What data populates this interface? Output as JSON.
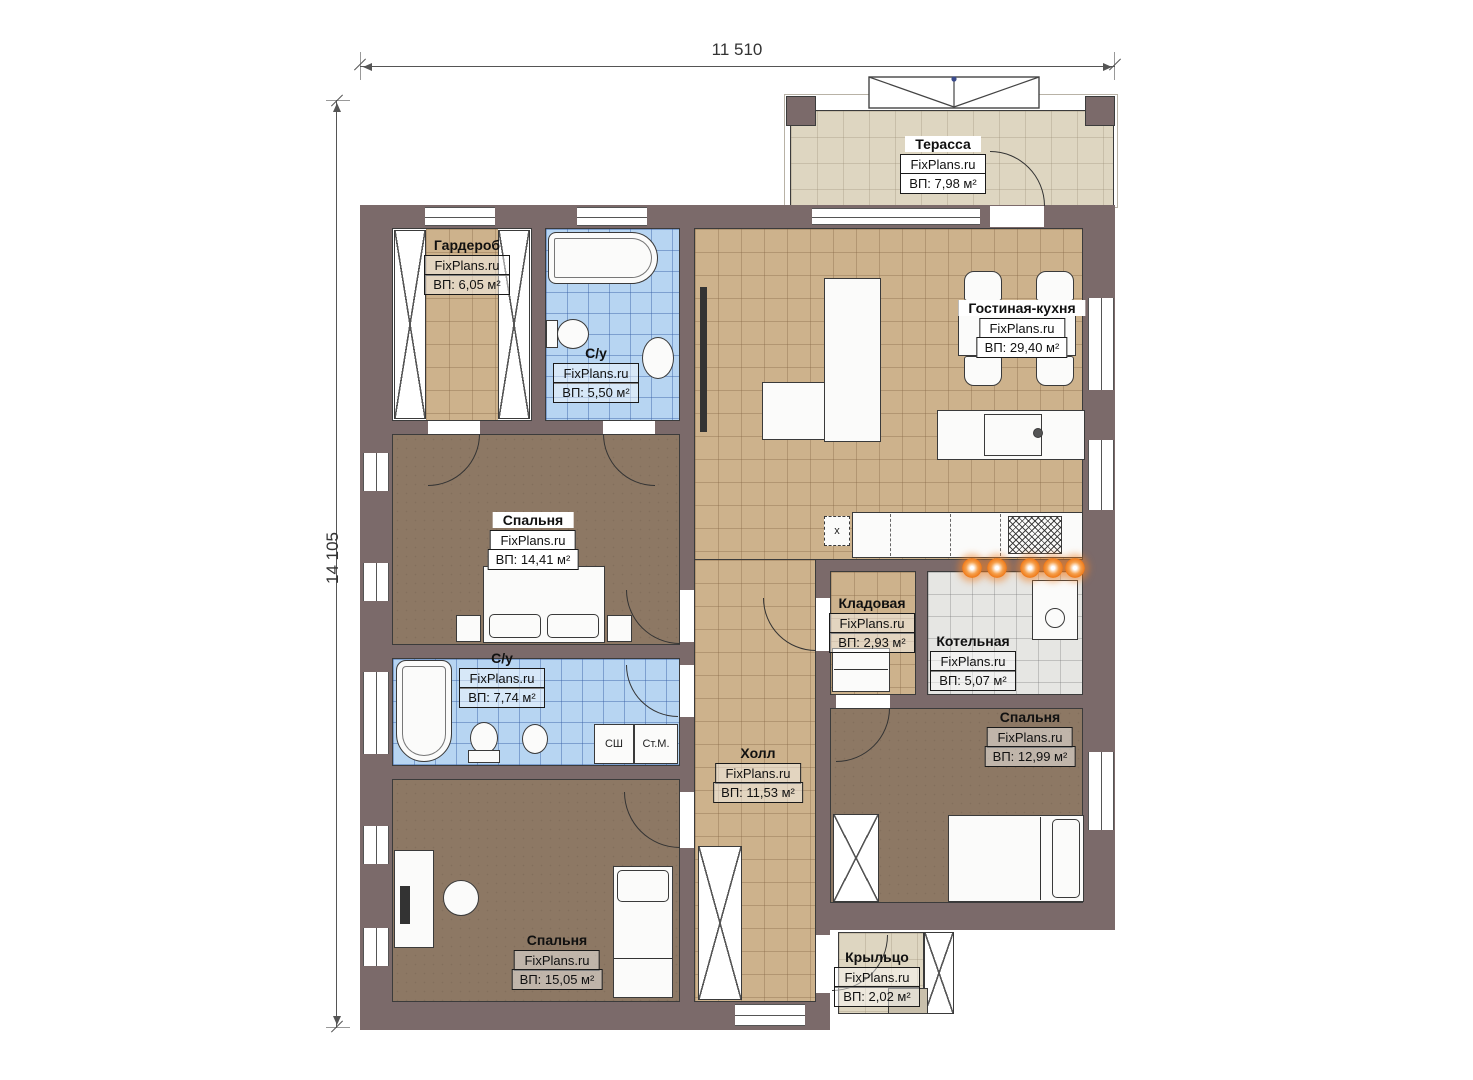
{
  "dimensions": {
    "width_label": "11 510",
    "height_label": "14 105"
  },
  "brand": "FixPlans.ru",
  "rooms": [
    {
      "id": "terrace",
      "label": "Терасса",
      "brand": "FixPlans.ru",
      "area": "ВП: 7,98 м²"
    },
    {
      "id": "wardrobe",
      "label": "Гардероб",
      "brand": "FixPlans.ru",
      "area": "ВП: 6,05 м²"
    },
    {
      "id": "bathroom-top",
      "label": "С/у",
      "brand": "FixPlans.ru",
      "area": "ВП: 5,50 м²"
    },
    {
      "id": "living-kitchen",
      "label": "Гостиная-кухня",
      "brand": "FixPlans.ru",
      "area": "ВП: 29,40 м²"
    },
    {
      "id": "bedroom-west",
      "label": "Спальня",
      "brand": "FixPlans.ru",
      "area": "ВП: 14,41 м²"
    },
    {
      "id": "bathroom-mid",
      "label": "С/у",
      "brand": "FixPlans.ru",
      "area": "ВП: 7,74 м²"
    },
    {
      "id": "pantry",
      "label": "Кладовая",
      "brand": "FixPlans.ru",
      "area": "ВП: 2,93 м²"
    },
    {
      "id": "boiler-room",
      "label": "Котельная",
      "brand": "FixPlans.ru",
      "area": "ВП: 5,07 м²"
    },
    {
      "id": "hall",
      "label": "Холл",
      "brand": "FixPlans.ru",
      "area": "ВП: 11,53 м²"
    },
    {
      "id": "bedroom-east",
      "label": "Спальня",
      "brand": "FixPlans.ru",
      "area": "ВП: 12,99 м²"
    },
    {
      "id": "bedroom-south",
      "label": "Спальня",
      "brand": "FixPlans.ru",
      "area": "ВП: 15,05 м²"
    },
    {
      "id": "porch",
      "label": "Крыльцо",
      "brand": "FixPlans.ru",
      "area": "ВП: 2,02 м²"
    }
  ],
  "fixtures": {
    "shower_cabin": "СШ",
    "washing_machine": "Ст.М.",
    "vent_shaft": "х"
  },
  "colors": {
    "wall": "#7b6a6a",
    "tile_tan": "#cdb28c",
    "tile_blue": "#b7d5f2",
    "floor_brown": "#8d7864",
    "terrace_beige": "#ded6c1",
    "boiler_gray": "#e6e6e3",
    "radiator_orange": "#ef7a1a"
  }
}
